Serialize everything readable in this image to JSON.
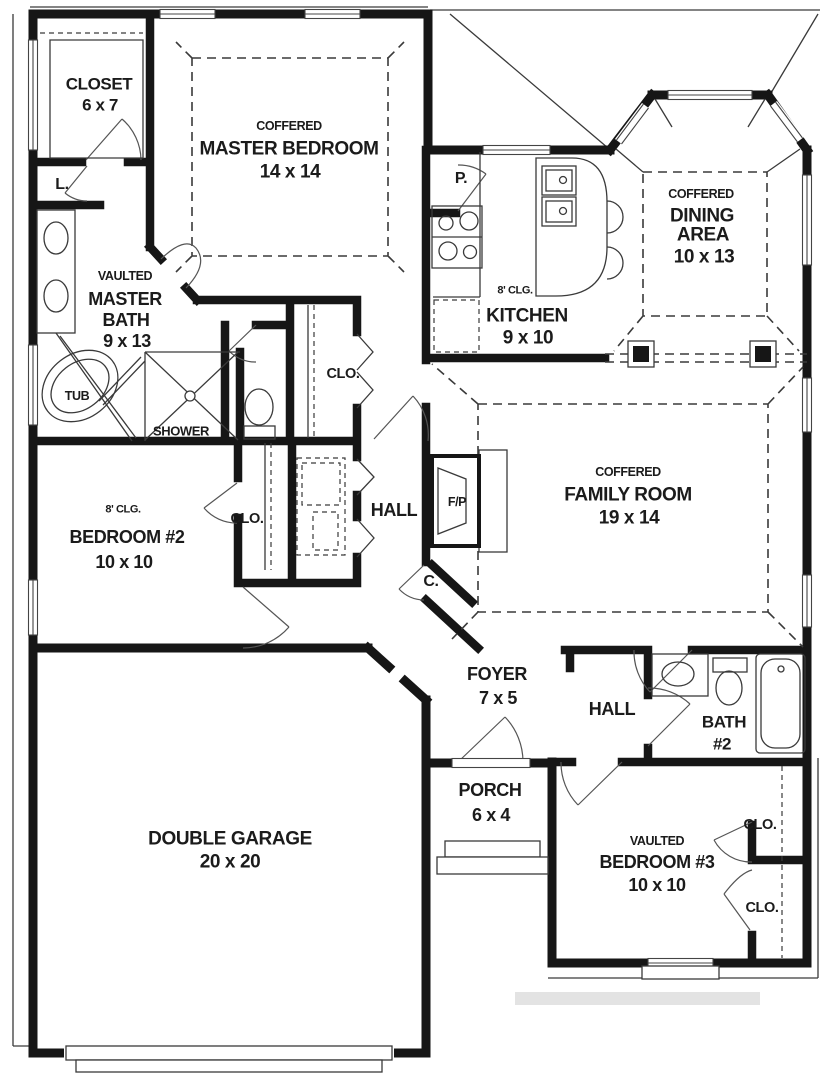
{
  "labels": {
    "closet": {
      "name": "CLOSET",
      "dims": "6 x 7"
    },
    "master_bedroom": {
      "ceiling": "COFFERED",
      "name": "MASTER BEDROOM",
      "dims": "14 x 14"
    },
    "master_bath": {
      "ceiling": "VAULTED",
      "line1": "MASTER",
      "line2": "BATH",
      "dims": "9 x 13"
    },
    "linen": "L.",
    "tub": "TUB",
    "shower": "SHOWER",
    "clo_hall": "CLO.",
    "pantry": "P.",
    "kitchen": {
      "ceiling": "8' CLG.",
      "name": "KITCHEN",
      "dims": "9 x 10"
    },
    "dining": {
      "ceiling": "COFFERED",
      "line1": "DINING",
      "line2": "AREA",
      "dims": "10 x 13"
    },
    "family": {
      "ceiling": "COFFERED",
      "name": "FAMILY ROOM",
      "dims": "19 x 14"
    },
    "bedroom2": {
      "ceiling": "8' CLG.",
      "name": "BEDROOM #2",
      "dims": "10 x 10"
    },
    "clo_bedroom2": "CLO.",
    "hall_center": "HALL",
    "fireplace": "F/P",
    "coat": "C.",
    "foyer": {
      "name": "FOYER",
      "dims": "7 x 5"
    },
    "hall_right": "HALL",
    "bath2": {
      "line1": "BATH",
      "line2": "#2"
    },
    "porch": {
      "name": "PORCH",
      "dims": "6 x 4"
    },
    "garage": {
      "name": "DOUBLE GARAGE",
      "dims": "20 x 20"
    },
    "bedroom3": {
      "ceiling": "VAULTED",
      "name": "BEDROOM #3",
      "dims": "10 x 10"
    },
    "clo_bedroom3_top": "CLO.",
    "clo_bedroom3_bottom": "CLO."
  },
  "colors": {
    "wall": "#161616",
    "line": "#3a3a3a",
    "text": "#1b1b1b",
    "bg": "#ffffff",
    "mark": "#e3e3e3"
  }
}
